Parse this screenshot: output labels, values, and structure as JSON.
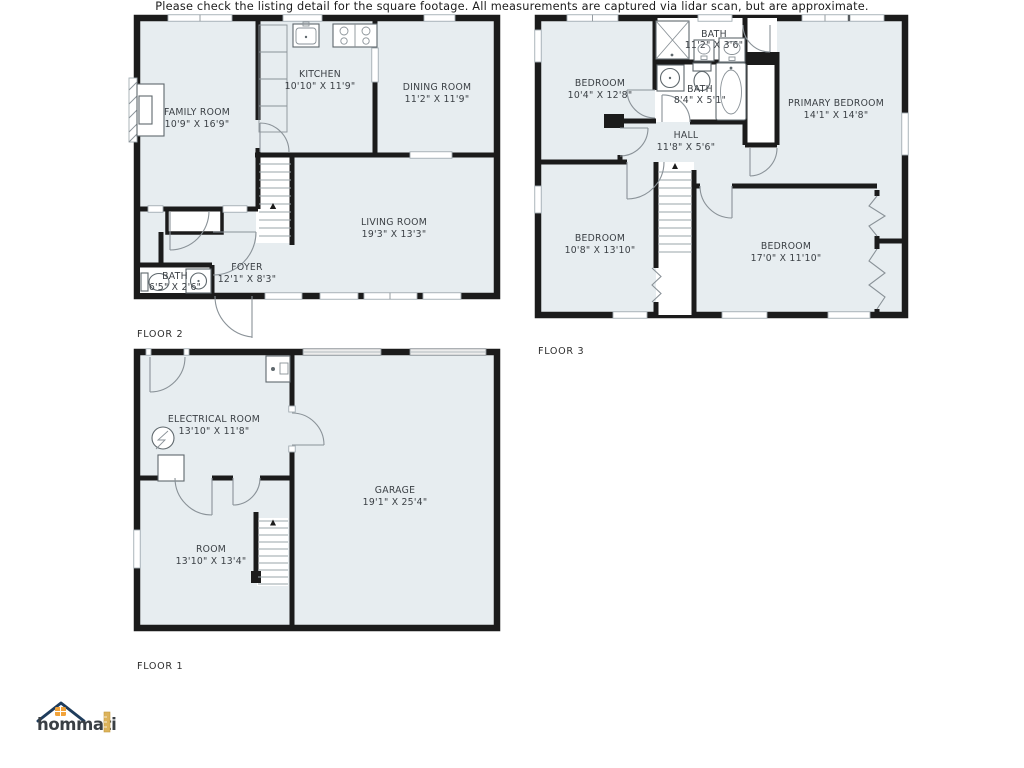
{
  "colors": {
    "room_fill": "#e7edf0",
    "wall": "#1b1b1b",
    "label_text": "#3a3f44",
    "logo_navy": "#1e3c5c",
    "logo_orange": "#f2a33a",
    "logo_gold": "#ddb35b"
  },
  "floor2": {
    "label": "FLOOR 2",
    "rooms": {
      "family": {
        "name": "FAMILY ROOM",
        "dims": "10'9\" X 16'9\""
      },
      "kitchen": {
        "name": "KITCHEN",
        "dims": "10'10\" X 11'9\""
      },
      "dining": {
        "name": "DINING ROOM",
        "dims": "11'2\" X 11'9\""
      },
      "living": {
        "name": "LIVING ROOM",
        "dims": "19'3\" X 13'3\""
      },
      "foyer": {
        "name": "FOYER",
        "dims": "12'1\" X 8'3\""
      },
      "bath": {
        "name": "BATH",
        "dims": "6'5\" X 2'6\""
      }
    }
  },
  "floor3": {
    "label": "FLOOR 3",
    "rooms": {
      "bedroom1": {
        "name": "BEDROOM",
        "dims": "10'4\" X 12'8\""
      },
      "bath1": {
        "name": "BATH",
        "dims": "11'2\" X 3'6\""
      },
      "bath2": {
        "name": "BATH",
        "dims": "8'4\" X 5'1\""
      },
      "primary": {
        "name": "PRIMARY BEDROOM",
        "dims": "14'1\" X 14'8\""
      },
      "hall": {
        "name": "HALL",
        "dims": "11'8\" X 5'6\""
      },
      "bedroom2": {
        "name": "BEDROOM",
        "dims": "10'8\" X 13'10\""
      },
      "bedroom3": {
        "name": "BEDROOM",
        "dims": "17'0\" X 11'10\""
      }
    }
  },
  "floor1": {
    "label": "FLOOR 1",
    "rooms": {
      "electrical": {
        "name": "ELECTRICAL ROOM",
        "dims": "13'10\" X 11'8\""
      },
      "garage": {
        "name": "GARAGE",
        "dims": "19'1\" X 25'4\""
      },
      "room": {
        "name": "ROOM",
        "dims": "13'10\" X 13'4\""
      }
    }
  },
  "branding": {
    "logo_text": "hommati"
  },
  "footer": {
    "disclaimer": "Please check the listing detail for the square footage. All measurements are captured via lidar scan, but are approximate."
  }
}
